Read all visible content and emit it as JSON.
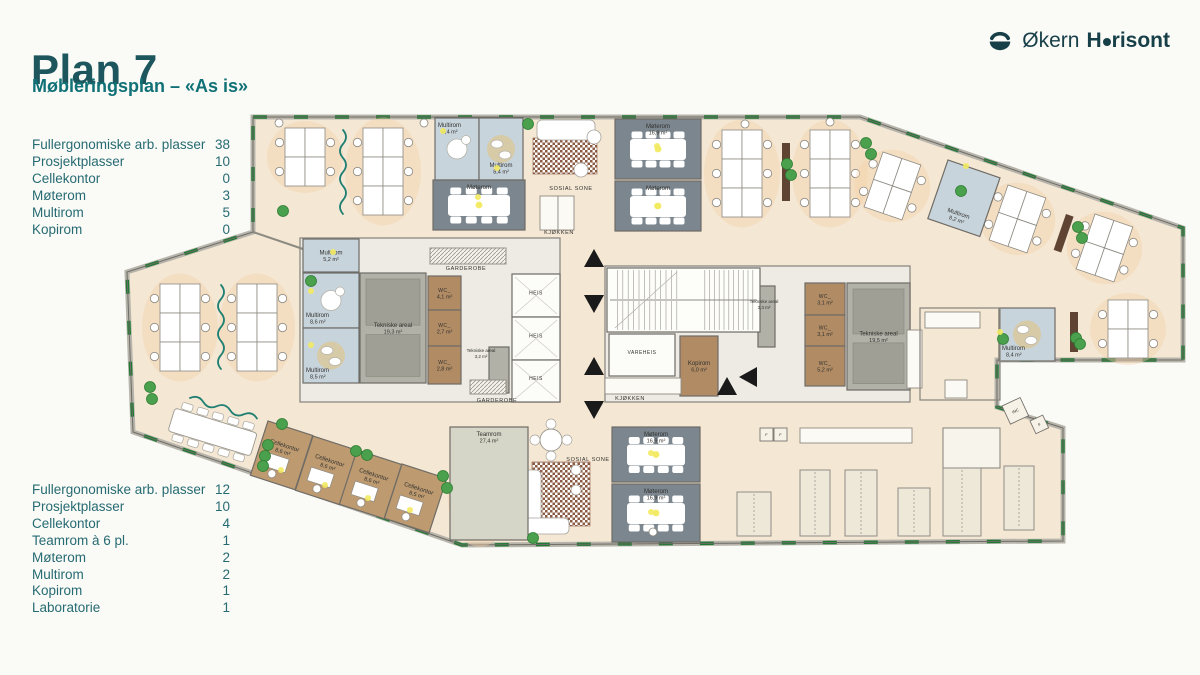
{
  "header": {
    "title": "Plan 7",
    "subtitle": "Møbleringsplan – «As is»"
  },
  "logo": {
    "regular": "Økern",
    "bold_prefix": "H",
    "bold_suffix": "risont"
  },
  "stats_upper": [
    {
      "label": "Fullergonomiske arb. plasser",
      "value": "38"
    },
    {
      "label": "Prosjektplasser",
      "value": "10"
    },
    {
      "label": "Cellekontor",
      "value": "0"
    },
    {
      "label": "Møterom",
      "value": "3"
    },
    {
      "label": "Multirom",
      "value": "5"
    },
    {
      "label": "Kopirom",
      "value": "0"
    }
  ],
  "stats_lower": [
    {
      "label": "Fullergonomiske arb. plasser",
      "value": "12"
    },
    {
      "label": "Prosjektplasser",
      "value": "10"
    },
    {
      "label": "Cellekontor",
      "value": "4"
    },
    {
      "label": "Teamrom à 6 pl.",
      "value": "1"
    },
    {
      "label": "Møterom",
      "value": "2"
    },
    {
      "label": "Multirom",
      "value": "2"
    },
    {
      "label": "Kopirom",
      "value": "1"
    },
    {
      "label": "Laboratorie",
      "value": "1"
    }
  ],
  "colors": {
    "floor": "#f4e7d4",
    "core": "#edebe3",
    "wall": "#6f6c66",
    "wallBase": "#b7b4ab",
    "window": "#1e7a33",
    "slate": "#7b868e",
    "blue": "#c8d4dc",
    "brown": "#b08b64",
    "brownL": "#bd9a70",
    "gray": "#b2b1a8",
    "grayIn": "#a09f96",
    "white": "#fcfcf9",
    "team": "#d5d6c7",
    "rug": "#8a5a43",
    "plant": "#4aa04c",
    "plantEdge": "#2e7d33",
    "light": "#f2ea5f",
    "squiggle": "#1f7f72",
    "glow": "#f5d3a8",
    "sideboard": "#5f4433",
    "benchFill": "#eee8d8",
    "benchEdge": "#8f8d86",
    "labelInk": "#33322f"
  },
  "floorplan": {
    "outline": "253,117 860,117 1183,228 1183,360 997,360 997,407 1063,428 1063,541 462,545 133,432 127,272 253,232",
    "cores": [
      [
        300,
        238,
        260,
        164
      ],
      [
        605,
        266,
        305,
        136
      ]
    ],
    "walls": [
      [
        253,
        232,
        303,
        249
      ]
    ],
    "rooms": [
      {
        "id": "multirom-top-1",
        "label": "Multirom",
        "area": "8,4 m²",
        "x": 435,
        "y": 118,
        "w": 44,
        "h": 62,
        "fill": "blue",
        "lp": "tl",
        "circle": "white"
      },
      {
        "id": "multirom-top-2",
        "label": "Multirom",
        "area": "8,4 m²",
        "x": 479,
        "y": 118,
        "w": 44,
        "h": 62,
        "fill": "blue",
        "lp": "bottom",
        "circle": "tan"
      },
      {
        "id": "moterom-top-left",
        "label": "Møterom",
        "area": "",
        "x": 433,
        "y": 180,
        "w": 92,
        "h": 50,
        "fill": "slate",
        "table": "conf",
        "lp": "top"
      },
      {
        "id": "moterom-top-mid",
        "label": "Møterom",
        "area": "16,9 m²",
        "x": 615,
        "y": 119,
        "w": 86,
        "h": 60,
        "fill": "slate",
        "table": "conf",
        "lp": "top"
      },
      {
        "id": "moterom-top-mid2",
        "label": "Møterom",
        "area": "",
        "x": 615,
        "y": 181,
        "w": 86,
        "h": 50,
        "fill": "slate",
        "table": "conf",
        "lp": "top"
      },
      {
        "id": "multirom-5-2",
        "label": "Multirom",
        "area": "5,2 m²",
        "x": 303,
        "y": 239,
        "w": 56,
        "h": 33,
        "fill": "blue"
      },
      {
        "id": "multirom-8-6",
        "label": "Multirom",
        "area": "8,6 m²",
        "x": 303,
        "y": 273,
        "w": 56,
        "h": 55,
        "fill": "blue",
        "lp": "bl",
        "circle": "white"
      },
      {
        "id": "multirom-8-5",
        "label": "Multirom",
        "area": "8,5 m²",
        "x": 303,
        "y": 328,
        "w": 56,
        "h": 55,
        "fill": "blue",
        "lp": "bl",
        "circle": "tan"
      },
      {
        "id": "tekniske-19-3",
        "label": "Tekniske areal",
        "area": "19,3 m²",
        "x": 360,
        "y": 273,
        "w": 66,
        "h": 110,
        "fill": "gray",
        "inner": true
      },
      {
        "id": "wc-4-1",
        "label": "WC_",
        "area": "4,1 m²",
        "x": 428,
        "y": 276,
        "w": 33,
        "h": 34,
        "fill": "brown"
      },
      {
        "id": "wc-2-7",
        "label": "WC_",
        "area": "2,7 m²",
        "x": 428,
        "y": 310,
        "w": 33,
        "h": 36,
        "fill": "brown"
      },
      {
        "id": "wc-2-8",
        "label": "WC_",
        "area": "2,8 m²",
        "x": 428,
        "y": 346,
        "w": 33,
        "h": 38,
        "fill": "brown"
      },
      {
        "id": "heis-1",
        "label": "HEIS",
        "area": "",
        "x": 512,
        "y": 274,
        "w": 48,
        "h": 43,
        "fill": "white",
        "x2": true
      },
      {
        "id": "heis-2",
        "label": "HEIS",
        "area": "",
        "x": 512,
        "y": 317,
        "w": 48,
        "h": 43,
        "fill": "white",
        "x2": true
      },
      {
        "id": "heis-3",
        "label": "HEIS",
        "area": "",
        "x": 512,
        "y": 360,
        "w": 48,
        "h": 42,
        "fill": "white",
        "x2": true
      },
      {
        "id": "tekniske-3-2",
        "label": "",
        "area": "",
        "x": 489,
        "y": 347,
        "w": 20,
        "h": 46,
        "fill": "gray"
      },
      {
        "id": "vareheis",
        "label": "VAREHEIS",
        "area": "",
        "x": 609,
        "y": 334,
        "w": 66,
        "h": 42,
        "fill": "white"
      },
      {
        "id": "kopirom",
        "label": "Kopirom",
        "area": "6,0 m²",
        "x": 680,
        "y": 336,
        "w": 38,
        "h": 60,
        "fill": "brown"
      },
      {
        "id": "tekniske-3-3",
        "label": "",
        "area": "",
        "x": 758,
        "y": 286,
        "w": 17,
        "h": 61,
        "fill": "gray"
      },
      {
        "id": "wc-3-1-a",
        "label": "WC_",
        "area": "3,1 m²",
        "x": 805,
        "y": 283,
        "w": 40,
        "h": 32,
        "fill": "brown"
      },
      {
        "id": "wc-3-1-b",
        "label": "WC_",
        "area": "3,1 m²",
        "x": 805,
        "y": 315,
        "w": 40,
        "h": 31,
        "fill": "brown"
      },
      {
        "id": "wc-5-2",
        "label": "WC_",
        "area": "5,2 m²",
        "x": 805,
        "y": 346,
        "w": 40,
        "h": 40,
        "fill": "brown"
      },
      {
        "id": "tekniske-19-5",
        "label": "Tekniske areal",
        "area": "19,5 m²",
        "x": 847,
        "y": 283,
        "w": 63,
        "h": 107,
        "fill": "gray",
        "inner": true
      },
      {
        "id": "multirom-8-2",
        "label": "Multirom",
        "area": "8,2 m²",
        "x": 948,
        "y": 160,
        "w": 55,
        "h": 62,
        "fill": "blue",
        "rot": 19,
        "lp": "bottom"
      },
      {
        "id": "multirom-8-4-right",
        "label": "Multirom",
        "area": "8,4 m²",
        "x": 999,
        "y": 308,
        "w": 56,
        "h": 53,
        "fill": "blue",
        "lp": "bl",
        "circle": "tan"
      },
      {
        "id": "teamrom",
        "label": "Teamrom",
        "area": "27,4 m²",
        "x": 450,
        "y": 427,
        "w": 78,
        "h": 113,
        "fill": "team",
        "lp": "top"
      },
      {
        "id": "moterom-bottom-1",
        "label": "Møterom",
        "area": "16,9 m²",
        "x": 612,
        "y": 427,
        "w": 88,
        "h": 55,
        "fill": "slate",
        "table": "conf",
        "lp": "top"
      },
      {
        "id": "moterom-bottom-2",
        "label": "Møterom",
        "area": "16,9 m²",
        "x": 612,
        "y": 484,
        "w": 88,
        "h": 58,
        "fill": "slate",
        "table": "conf",
        "lp": "top"
      },
      {
        "id": "cellekontor-1",
        "label": "Cellekontor",
        "area": "8,6 m²",
        "x": 268,
        "y": 421,
        "w": 47,
        "h": 57,
        "fill": "brownL",
        "rot": 18,
        "office": true
      },
      {
        "id": "cellekontor-2",
        "label": "Cellekontor",
        "area": "8,6 m²",
        "x": 313,
        "y": 436,
        "w": 47,
        "h": 57,
        "fill": "brownL",
        "rot": 18,
        "office": true
      },
      {
        "id": "cellekontor-3",
        "label": "Cellekontor",
        "area": "8,6 m²",
        "x": 357,
        "y": 450,
        "w": 47,
        "h": 57,
        "fill": "brownL",
        "rot": 18,
        "office": true
      },
      {
        "id": "cellekontor-4",
        "label": "Cellekontor",
        "area": "8,5 m²",
        "x": 402,
        "y": 464,
        "w": 47,
        "h": 57,
        "fill": "brownL",
        "rot": 18,
        "office": true
      }
    ],
    "texts": [
      {
        "t": "SOSIAL SONE",
        "x": 571,
        "y": 190,
        "s": 5.5
      },
      {
        "t": "KJØKKEN",
        "x": 559,
        "y": 234,
        "s": 5.5
      },
      {
        "t": "GARDEROBE",
        "x": 466,
        "y": 270,
        "s": 5.5
      },
      {
        "t": "GARDEROBE",
        "x": 497,
        "y": 402,
        "s": 5.5
      },
      {
        "t": "KJØKKEN",
        "x": 630,
        "y": 400,
        "s": 5.5
      },
      {
        "t": "SOSIAL SONE",
        "x": 588,
        "y": 461,
        "s": 5.5
      },
      {
        "t": "Tekniske areal",
        "x": 481,
        "y": 352,
        "s": 4.5
      },
      {
        "t": "3,2 m²",
        "x": 481,
        "y": 358,
        "s": 4.5
      },
      {
        "t": "Tekniske areal",
        "x": 764,
        "y": 303,
        "s": 4.5
      },
      {
        "t": "3,3 m²",
        "x": 764,
        "y": 309,
        "s": 4.5
      }
    ],
    "clusters": [
      {
        "x": 285,
        "y": 128,
        "c": 2,
        "r": 2
      },
      {
        "x": 363,
        "y": 128,
        "c": 2,
        "r": 3
      },
      {
        "x": 722,
        "y": 130,
        "c": 2,
        "r": 3
      },
      {
        "x": 810,
        "y": 130,
        "c": 2,
        "r": 3
      },
      {
        "x": 883,
        "y": 152,
        "c": 2,
        "r": 2,
        "rot": 19
      },
      {
        "x": 1008,
        "y": 185,
        "c": 2,
        "r": 2,
        "rot": 19
      },
      {
        "x": 1095,
        "y": 214,
        "c": 2,
        "r": 2,
        "rot": 19
      },
      {
        "x": 1108,
        "y": 300,
        "c": 2,
        "r": 2
      },
      {
        "x": 160,
        "y": 284,
        "c": 2,
        "r": 3
      },
      {
        "x": 237,
        "y": 284,
        "c": 2,
        "r": 3
      },
      {
        "x": 463,
        "y": 456,
        "c": 2,
        "r": 3,
        "dw": 17,
        "dh": 27
      }
    ],
    "longtable": {
      "x": 175,
      "y": 408,
      "rot": 17,
      "w": 86,
      "h": 24,
      "chairs": 5
    },
    "stairs": {
      "x": 607,
      "y": 268,
      "w": 153,
      "h": 64
    },
    "lockers": [
      [
        430,
        248,
        76,
        16
      ],
      [
        470,
        380,
        36,
        14
      ]
    ],
    "counters": [
      [
        540,
        196,
        18,
        34
      ],
      [
        558,
        196,
        16,
        34
      ],
      [
        605,
        378,
        76,
        16
      ],
      [
        925,
        312,
        55,
        16
      ],
      [
        907,
        330,
        15,
        58
      ],
      [
        945,
        380,
        22,
        18
      ],
      [
        800,
        428,
        112,
        15
      ]
    ],
    "smallroom": [
      943,
      428,
      57,
      40
    ],
    "kitchenette": [
      920,
      308,
      80,
      92
    ],
    "rugs": [
      [
        533,
        138,
        64,
        36
      ],
      [
        532,
        462,
        58,
        64
      ]
    ],
    "sofas": [
      [
        537,
        120,
        58,
        20
      ],
      [
        523,
        470,
        18,
        64
      ],
      [
        523,
        518,
        46,
        16
      ]
    ],
    "roundtables": [
      [
        551,
        440,
        11
      ]
    ],
    "loungechairs": [
      [
        594,
        137,
        7
      ],
      [
        581,
        170,
        7
      ],
      [
        576,
        470,
        5
      ],
      [
        576,
        490,
        5
      ]
    ],
    "benches": [
      [
        737,
        492,
        34,
        44
      ],
      [
        800,
        470,
        30,
        66
      ],
      [
        845,
        470,
        32,
        66
      ],
      [
        898,
        488,
        32,
        48
      ],
      [
        943,
        468,
        38,
        68
      ],
      [
        1004,
        466,
        30,
        64
      ]
    ],
    "applianceboxes": [
      {
        "x": 1002,
        "y": 406,
        "s": 20,
        "rot": -25,
        "label": "INC"
      },
      {
        "x": 1030,
        "y": 421,
        "s": 14,
        "rot": -25,
        "label": "F"
      },
      {
        "x": 760,
        "y": 428,
        "s": 13,
        "rot": 0,
        "label": "F"
      },
      {
        "x": 774,
        "y": 428,
        "s": 13,
        "rot": 0,
        "label": "F"
      }
    ],
    "sideboards": [
      [
        782,
        143,
        8,
        58,
        0
      ],
      [
        1066,
        214,
        8,
        38,
        19
      ],
      [
        1070,
        312,
        8,
        40,
        0
      ]
    ],
    "plants": [
      [
        283,
        211
      ],
      [
        528,
        124
      ],
      [
        787,
        164
      ],
      [
        791,
        175
      ],
      [
        866,
        143
      ],
      [
        871,
        154
      ],
      [
        311,
        281
      ],
      [
        150,
        387
      ],
      [
        152,
        399
      ],
      [
        268,
        445
      ],
      [
        265,
        456
      ],
      [
        263,
        466
      ],
      [
        282,
        424
      ],
      [
        356,
        451
      ],
      [
        367,
        455
      ],
      [
        443,
        476
      ],
      [
        447,
        488
      ],
      [
        533,
        538
      ],
      [
        961,
        191
      ],
      [
        1078,
        227
      ],
      [
        1082,
        238
      ],
      [
        1076,
        338
      ],
      [
        1080,
        344
      ],
      [
        1003,
        339
      ]
    ],
    "lights": [
      [
        478,
        197
      ],
      [
        657,
        146
      ],
      [
        657,
        206
      ],
      [
        443,
        131
      ],
      [
        497,
        168
      ],
      [
        311,
        291
      ],
      [
        311,
        345
      ],
      [
        333,
        252
      ],
      [
        966,
        166
      ],
      [
        1000,
        332
      ],
      [
        281,
        470
      ],
      [
        325,
        485
      ],
      [
        368,
        498
      ],
      [
        410,
        510
      ],
      [
        651,
        453
      ],
      [
        651,
        512
      ]
    ],
    "arrows": [
      [
        594,
        258,
        "up"
      ],
      [
        594,
        304,
        "down"
      ],
      [
        594,
        366,
        "up"
      ],
      [
        594,
        410,
        "down"
      ],
      [
        727,
        386,
        "up"
      ],
      [
        748,
        377,
        "left"
      ]
    ],
    "squiggles": [
      {
        "x": 343,
        "y": 130,
        "dir": "v"
      },
      {
        "x": 221,
        "y": 285,
        "dir": "v"
      },
      {
        "x": 190,
        "y": 398,
        "dir": "h",
        "rot": 17
      }
    ],
    "columns": [
      [
        279,
        123
      ],
      [
        424,
        123
      ],
      [
        745,
        124
      ],
      [
        830,
        122
      ],
      [
        653,
        532
      ]
    ]
  }
}
